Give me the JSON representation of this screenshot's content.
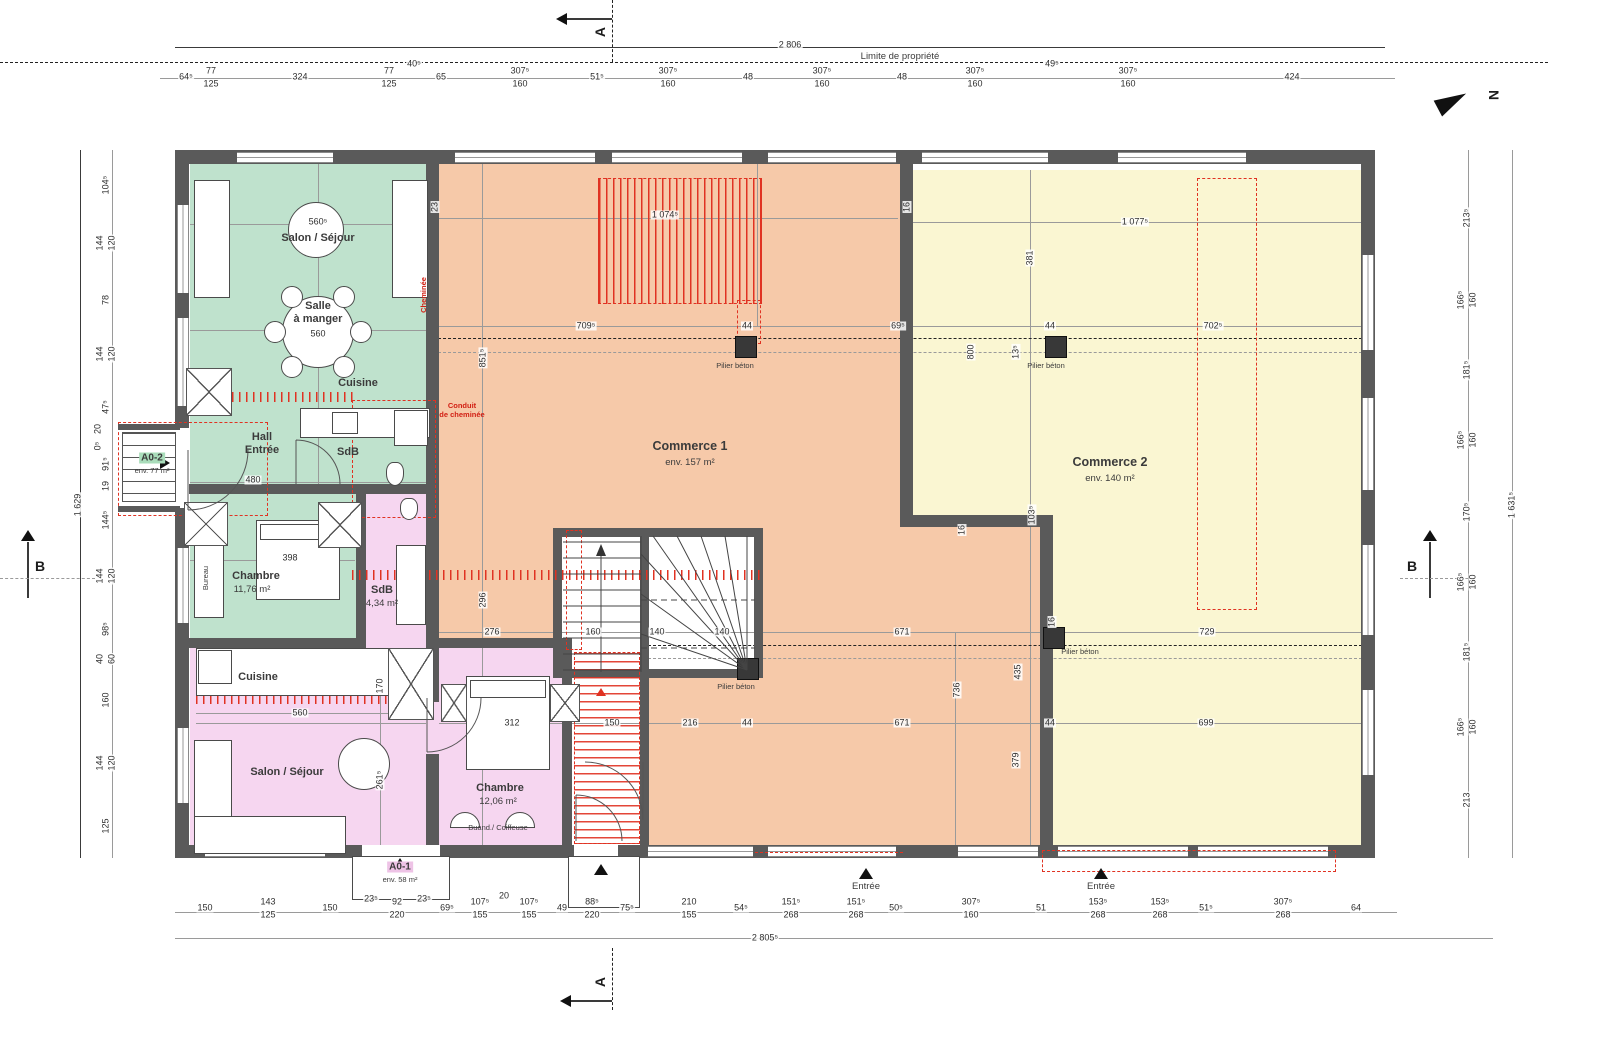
{
  "colors": {
    "apartment_a02_green": "#bfe2cd",
    "apartment_a01_pink": "#f6d6f0",
    "commerce1_orange": "#f6c9a9",
    "commerce2_yellow": "#faf6d2",
    "wall_gray": "#5a5a5a",
    "annotation_red": "#e03222"
  },
  "annotations": {
    "limite": "Limite de propriété",
    "pilier": "Pilier béton",
    "entree": "Entrée",
    "conduit1": "Conduit",
    "conduit2": "de cheminée",
    "cheminee": "Cheminée",
    "bureau": "Bureau"
  },
  "sections": {
    "a": "A",
    "b": "B",
    "north": "N"
  },
  "rooms": {
    "a02": {
      "label": "A0-2",
      "area": "env. 77 m²",
      "salon": "Salon / Séjour",
      "salle1": "Salle",
      "salle2": "à manger",
      "cuisine": "Cuisine",
      "hall1": "Hall",
      "hall2": "Entrée",
      "sdb": "SdB",
      "chambre": "Chambre",
      "chambre_area": "11,76 m²"
    },
    "a01": {
      "label": "A0-1",
      "area": "env. 58 m²",
      "cuisine": "Cuisine",
      "salon": "Salon / Séjour",
      "sdb": "SdB",
      "sdb_area": "4,34 m²",
      "chambre": "Chambre",
      "chambre_area": "12,06 m²",
      "buand": "Buand./ Coiffeuse"
    },
    "commerce1": {
      "name": "Commerce 1",
      "area": "env. 157 m²"
    },
    "commerce2": {
      "name": "Commerce 2",
      "area": "env. 140 m²"
    }
  },
  "dim_labels": [
    [
      186,
      77,
      0,
      "64⁵"
    ],
    [
      211,
      71,
      0,
      "77"
    ],
    [
      211,
      84,
      0,
      "125"
    ],
    [
      300,
      77,
      0,
      "324"
    ],
    [
      389,
      71,
      0,
      "77"
    ],
    [
      389,
      84,
      0,
      "125"
    ],
    [
      414,
      64,
      0,
      "40⁵"
    ],
    [
      441,
      77,
      0,
      "65"
    ],
    [
      520,
      71,
      0,
      "307⁵"
    ],
    [
      520,
      84,
      0,
      "160"
    ],
    [
      597,
      77,
      0,
      "51⁵"
    ],
    [
      668,
      71,
      0,
      "307⁵"
    ],
    [
      668,
      84,
      0,
      "160"
    ],
    [
      748,
      77,
      0,
      "48"
    ],
    [
      822,
      71,
      0,
      "307⁵"
    ],
    [
      822,
      84,
      0,
      "160"
    ],
    [
      902,
      77,
      0,
      "48"
    ],
    [
      975,
      71,
      0,
      "307⁵"
    ],
    [
      975,
      84,
      0,
      "160"
    ],
    [
      1052,
      64,
      0,
      "49⁵"
    ],
    [
      1128,
      71,
      0,
      "307⁵"
    ],
    [
      1128,
      84,
      0,
      "160"
    ],
    [
      1292,
      77,
      0,
      "424"
    ],
    [
      790,
      45,
      0,
      "2 806"
    ],
    [
      205,
      908,
      0,
      "150"
    ],
    [
      268,
      902,
      0,
      "143"
    ],
    [
      268,
      915,
      0,
      "125"
    ],
    [
      330,
      908,
      0,
      "150"
    ],
    [
      371,
      899,
      0,
      "23⁵"
    ],
    [
      397,
      902,
      0,
      "92"
    ],
    [
      397,
      915,
      0,
      "220"
    ],
    [
      424,
      899,
      0,
      "23⁵"
    ],
    [
      447,
      908,
      0,
      "69⁵"
    ],
    [
      480,
      902,
      0,
      "107⁵"
    ],
    [
      480,
      915,
      0,
      "155"
    ],
    [
      504,
      896,
      0,
      "20"
    ],
    [
      529,
      902,
      0,
      "107⁵"
    ],
    [
      529,
      915,
      0,
      "155"
    ],
    [
      562,
      908,
      0,
      "49"
    ],
    [
      592,
      902,
      0,
      "88⁵"
    ],
    [
      592,
      915,
      0,
      "220"
    ],
    [
      627,
      908,
      0,
      "75⁵"
    ],
    [
      689,
      902,
      0,
      "210"
    ],
    [
      689,
      915,
      0,
      "155"
    ],
    [
      741,
      908,
      0,
      "54⁵"
    ],
    [
      791,
      902,
      0,
      "151⁵"
    ],
    [
      791,
      915,
      0,
      "268"
    ],
    [
      856,
      902,
      0,
      "151⁵"
    ],
    [
      856,
      915,
      0,
      "268"
    ],
    [
      896,
      908,
      0,
      "50⁵"
    ],
    [
      971,
      902,
      0,
      "307⁵"
    ],
    [
      971,
      915,
      0,
      "160"
    ],
    [
      1041,
      908,
      0,
      "51"
    ],
    [
      1098,
      902,
      0,
      "153⁵"
    ],
    [
      1098,
      915,
      0,
      "268"
    ],
    [
      1160,
      902,
      0,
      "153⁵"
    ],
    [
      1160,
      915,
      0,
      "268"
    ],
    [
      1206,
      908,
      0,
      "51⁵"
    ],
    [
      1283,
      902,
      0,
      "307⁵"
    ],
    [
      1283,
      915,
      0,
      "268"
    ],
    [
      1356,
      908,
      0,
      "64"
    ],
    [
      765,
      938,
      0,
      "2 805⁵"
    ],
    [
      106,
      185,
      1,
      "104⁵"
    ],
    [
      100,
      243,
      1,
      "144"
    ],
    [
      112,
      243,
      1,
      "120"
    ],
    [
      106,
      300,
      1,
      "78"
    ],
    [
      100,
      354,
      1,
      "144"
    ],
    [
      112,
      354,
      1,
      "120"
    ],
    [
      106,
      407,
      1,
      "47⁵"
    ],
    [
      98,
      429,
      1,
      "20"
    ],
    [
      98,
      446,
      1,
      "0⁵"
    ],
    [
      106,
      464,
      1,
      "91⁵"
    ],
    [
      106,
      486,
      1,
      "19"
    ],
    [
      106,
      520,
      1,
      "144⁵"
    ],
    [
      100,
      576,
      1,
      "144"
    ],
    [
      112,
      576,
      1,
      "120"
    ],
    [
      106,
      629,
      1,
      "98⁵"
    ],
    [
      100,
      659,
      1,
      "40"
    ],
    [
      112,
      659,
      1,
      "60"
    ],
    [
      106,
      700,
      1,
      "160"
    ],
    [
      100,
      763,
      1,
      "144"
    ],
    [
      112,
      763,
      1,
      "120"
    ],
    [
      106,
      826,
      1,
      "125"
    ],
    [
      78,
      505,
      1,
      "1 629"
    ],
    [
      1467,
      218,
      1,
      "213⁵"
    ],
    [
      1461,
      300,
      1,
      "166⁵"
    ],
    [
      1473,
      300,
      1,
      "160"
    ],
    [
      1467,
      370,
      1,
      "181⁵"
    ],
    [
      1461,
      440,
      1,
      "166⁵"
    ],
    [
      1473,
      440,
      1,
      "160"
    ],
    [
      1467,
      512,
      1,
      "170⁵"
    ],
    [
      1461,
      582,
      1,
      "166⁵"
    ],
    [
      1473,
      582,
      1,
      "160"
    ],
    [
      1467,
      652,
      1,
      "181⁵"
    ],
    [
      1461,
      727,
      1,
      "166⁵"
    ],
    [
      1473,
      727,
      1,
      "160"
    ],
    [
      1467,
      800,
      1,
      "213"
    ],
    [
      1512,
      505,
      1,
      "1 631⁵"
    ],
    [
      665,
      215,
      0,
      "1 074⁵"
    ],
    [
      1135,
      222,
      0,
      "1 077⁵"
    ],
    [
      586,
      326,
      0,
      "709⁵"
    ],
    [
      747,
      326,
      0,
      "44"
    ],
    [
      898,
      326,
      0,
      "69⁵"
    ],
    [
      1050,
      326,
      0,
      "44"
    ],
    [
      1213,
      326,
      0,
      "702⁵"
    ],
    [
      483,
      358,
      1,
      "851⁵"
    ],
    [
      1030,
      258,
      1,
      "381"
    ],
    [
      971,
      352,
      1,
      "800"
    ],
    [
      1016,
      352,
      1,
      "13⁵"
    ],
    [
      1032,
      515,
      1,
      "103⁵"
    ],
    [
      962,
      530,
      1,
      "16"
    ],
    [
      1052,
      622,
      1,
      "16"
    ],
    [
      483,
      600,
      1,
      "296"
    ],
    [
      492,
      632,
      0,
      "276"
    ],
    [
      593,
      632,
      0,
      "160"
    ],
    [
      657,
      632,
      0,
      "140"
    ],
    [
      722,
      632,
      0,
      "140"
    ],
    [
      902,
      632,
      0,
      "671"
    ],
    [
      1207,
      632,
      0,
      "729"
    ],
    [
      1018,
      672,
      1,
      "435"
    ],
    [
      957,
      690,
      1,
      "736"
    ],
    [
      1016,
      760,
      1,
      "379"
    ],
    [
      512,
      723,
      0,
      "312"
    ],
    [
      612,
      723,
      0,
      "150"
    ],
    [
      690,
      723,
      0,
      "216"
    ],
    [
      747,
      723,
      0,
      "44"
    ],
    [
      902,
      723,
      0,
      "671"
    ],
    [
      1050,
      723,
      0,
      "44"
    ],
    [
      1206,
      723,
      0,
      "699"
    ],
    [
      318,
      222,
      0,
      "560⁵"
    ],
    [
      318,
      334,
      0,
      "560"
    ],
    [
      253,
      480,
      0,
      "480"
    ],
    [
      290,
      558,
      0,
      "398"
    ],
    [
      300,
      713,
      0,
      "560"
    ],
    [
      380,
      686,
      1,
      "170"
    ],
    [
      380,
      780,
      1,
      "261⁵"
    ],
    [
      435,
      207,
      1,
      "23"
    ],
    [
      907,
      207,
      1,
      "16"
    ]
  ]
}
